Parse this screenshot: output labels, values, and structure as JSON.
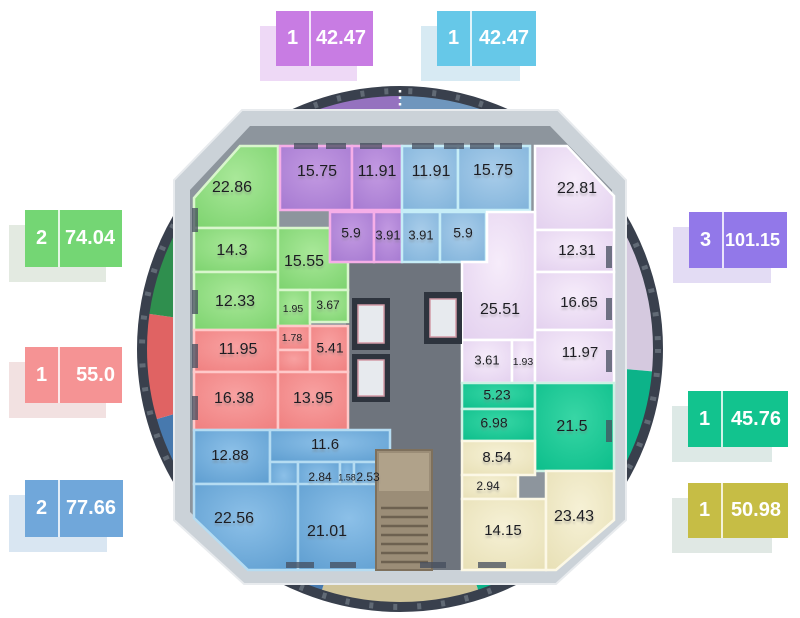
{
  "page": {
    "title": "Residential floor plan with apartment areas"
  },
  "callouts": [
    {
      "id": "top-left-purple",
      "rooms_count": "1",
      "area": "42.47",
      "fill": "#c87ce3",
      "shadow": "#eed9f6"
    },
    {
      "id": "top-right-cyan",
      "rooms_count": "1",
      "area": "42.47",
      "fill": "#66c8e8",
      "shadow": "#d7eaf3"
    },
    {
      "id": "left-green",
      "rooms_count": "2",
      "area": "74.04",
      "fill": "#74d674",
      "shadow": "#e3eae1"
    },
    {
      "id": "left-red",
      "rooms_count": "1",
      "area": "55.0",
      "fill": "#f59394",
      "shadow": "#f2e1e1"
    },
    {
      "id": "left-blue",
      "rooms_count": "2",
      "area": "77.66",
      "fill": "#70a7da",
      "shadow": "#d9e6f2"
    },
    {
      "id": "right-violet",
      "rooms_count": "3",
      "area": "101.15",
      "fill": "#9278e9",
      "shadow": "#e3dcf4"
    },
    {
      "id": "right-teal",
      "rooms_count": "1",
      "area": "45.76",
      "fill": "#12c38e",
      "shadow": "#dde9e6"
    },
    {
      "id": "right-olive",
      "rooms_count": "1",
      "area": "50.98",
      "fill": "#c6bd45",
      "shadow": "#e0e8e4"
    }
  ],
  "apartments": [
    {
      "id": "green",
      "callout": "left-green",
      "rooms": [
        "22.86",
        "14.3",
        "12.33",
        "15.55",
        "1.95",
        "3.67"
      ]
    },
    {
      "id": "purple-top",
      "callout": "top-left-purple",
      "rooms": [
        "15.75",
        "11.91",
        "5.9",
        "3.91"
      ]
    },
    {
      "id": "cyan-top",
      "callout": "top-right-cyan",
      "rooms": [
        "11.91",
        "15.75",
        "3.91",
        "5.9"
      ]
    },
    {
      "id": "violet-right",
      "callout": "right-violet",
      "rooms": [
        "22.81",
        "12.31",
        "16.65",
        "25.51",
        "3.61",
        "1.93",
        "11.97"
      ]
    },
    {
      "id": "red",
      "callout": "left-red",
      "rooms": [
        "11.95",
        "1.78",
        "5.41",
        "16.38",
        "13.95"
      ]
    },
    {
      "id": "teal",
      "callout": "right-teal",
      "rooms": [
        "5.23",
        "6.98",
        "21.5"
      ]
    },
    {
      "id": "blue",
      "callout": "left-blue",
      "rooms": [
        "12.88",
        "11.6",
        "2.84",
        "1.58",
        "2.53",
        "22.56",
        "21.01"
      ]
    },
    {
      "id": "olive",
      "callout": "right-olive",
      "rooms": [
        "8.54",
        "2.94",
        "14.15",
        "23.43"
      ]
    }
  ],
  "colors": {
    "room_green": "#7bd26d",
    "room_purple": "#a478d0",
    "room_cyan": "#7fb2da",
    "room_lavender": "#e2cfee",
    "room_red": "#ef7e7e",
    "room_teal": "#0abd8a",
    "room_blue": "#5c9ccf",
    "room_olive": "#e7dfb4",
    "core_gray": "#6e747d",
    "wall_gray": "#cbd2d8",
    "balcony_rim": "#39404d"
  }
}
